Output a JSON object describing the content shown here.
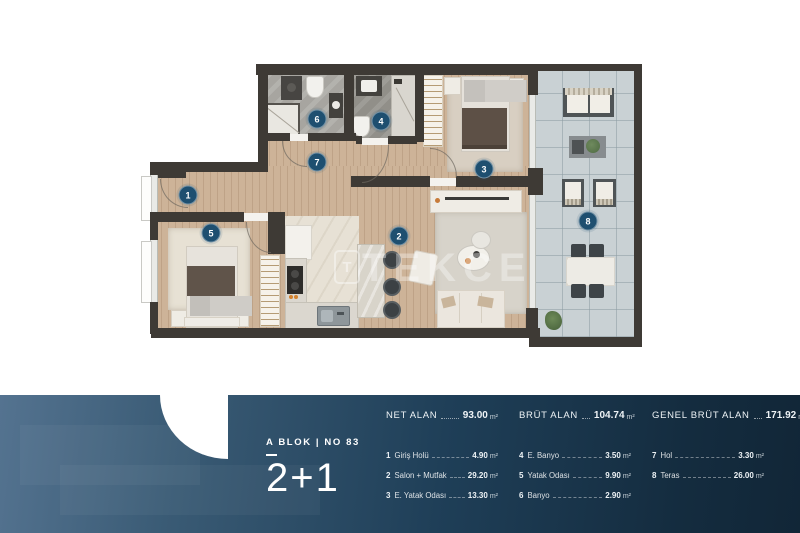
{
  "floor_plan": {
    "watermark": "TEKCE",
    "watermark_logo_letter": "T",
    "badge_color": "#1e4f70",
    "badges": [
      "1",
      "2",
      "3",
      "4",
      "5",
      "6",
      "7",
      "8"
    ]
  },
  "info_panel": {
    "block_no": "A BLOK | NO 83",
    "plan_type": "2+1",
    "panel_gradient_left": "#547390",
    "panel_gradient_right": "#112637",
    "summary": [
      {
        "label": "NET ALAN",
        "value": "93.00",
        "unit": "m²"
      },
      {
        "label": "BRÜT ALAN",
        "value": "104.74",
        "unit": "m²"
      },
      {
        "label": "GENEL BRÜT ALAN",
        "value": "171.92",
        "unit": "m²"
      }
    ],
    "rooms": [
      {
        "num": "1",
        "name": "Giriş Holü",
        "value": "4.90",
        "unit": "m²"
      },
      {
        "num": "2",
        "name": "Salon + Mutfak",
        "value": "29.20",
        "unit": "m²"
      },
      {
        "num": "3",
        "name": "E. Yatak Odası",
        "value": "13.30",
        "unit": "m²"
      },
      {
        "num": "4",
        "name": "E. Banyo",
        "value": "3.50",
        "unit": "m²"
      },
      {
        "num": "5",
        "name": "Yatak Odası",
        "value": "9.90",
        "unit": "m²"
      },
      {
        "num": "6",
        "name": "Banyo",
        "value": "2.90",
        "unit": "m²"
      },
      {
        "num": "7",
        "name": "Hol",
        "value": "3.30",
        "unit": "m²"
      },
      {
        "num": "8",
        "name": "Teras",
        "value": "26.00",
        "unit": "m²"
      }
    ]
  }
}
